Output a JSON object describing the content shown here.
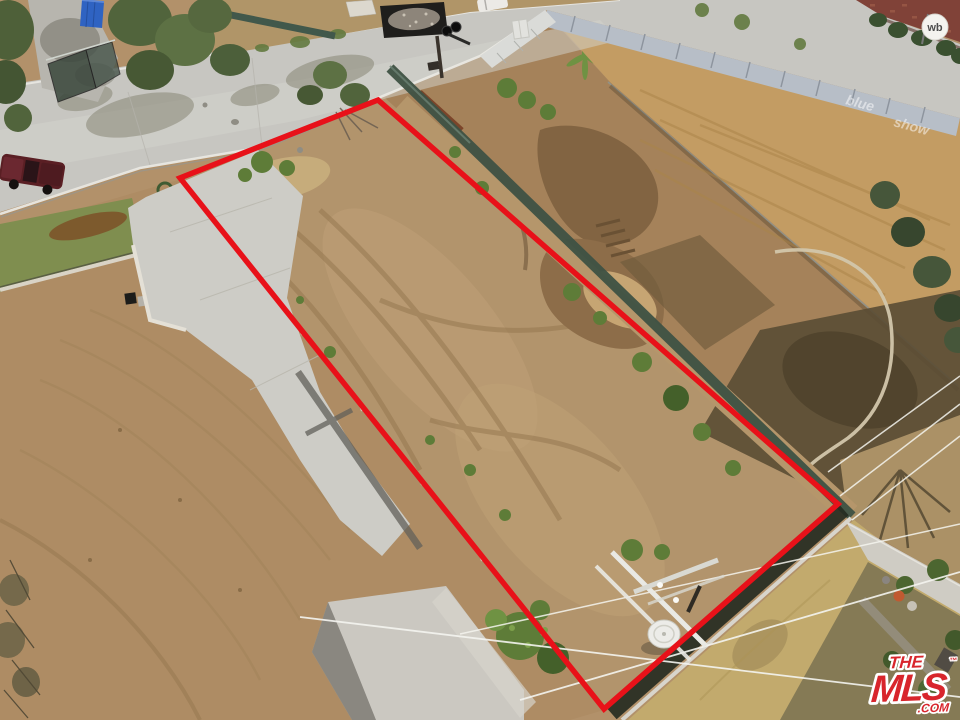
{
  "watermark": {
    "line1": "THE",
    "line2": "MLS",
    "suffix": ".COM",
    "trademark": "™",
    "logo_red": "#d8252c",
    "outline_white": "#ffffff"
  },
  "signs": {
    "roundel": "wb",
    "fence_text_a": "blue",
    "fence_text_b": "show"
  },
  "property_outline": {
    "points": "378,100 838,504 604,709 180,178",
    "stroke": "#e81119",
    "stroke_width": "5.5",
    "corner_top": "378,100",
    "corner_right": "838,504",
    "corner_bottom": "604,709",
    "corner_left": "180,178"
  },
  "palette": {
    "dirt_base": "#b2916a",
    "dirt_light": "#c8b184",
    "dirt_track": "#93754e",
    "graded_lot": "#c39c63",
    "street_gray": "#c7c6c1",
    "concrete": "#cdccc6",
    "fence_teal": "#3f5244",
    "tree_green": "#51643c",
    "weed_green": "#5e7c38",
    "shadow_brown": "#5a4c34",
    "dry_grass": "#c2aa6d",
    "panel_gray": "#b7bec7",
    "brick_wall": "#804238",
    "truck_maroon": "#5a1f24",
    "container_blue": "#2f63c2"
  }
}
